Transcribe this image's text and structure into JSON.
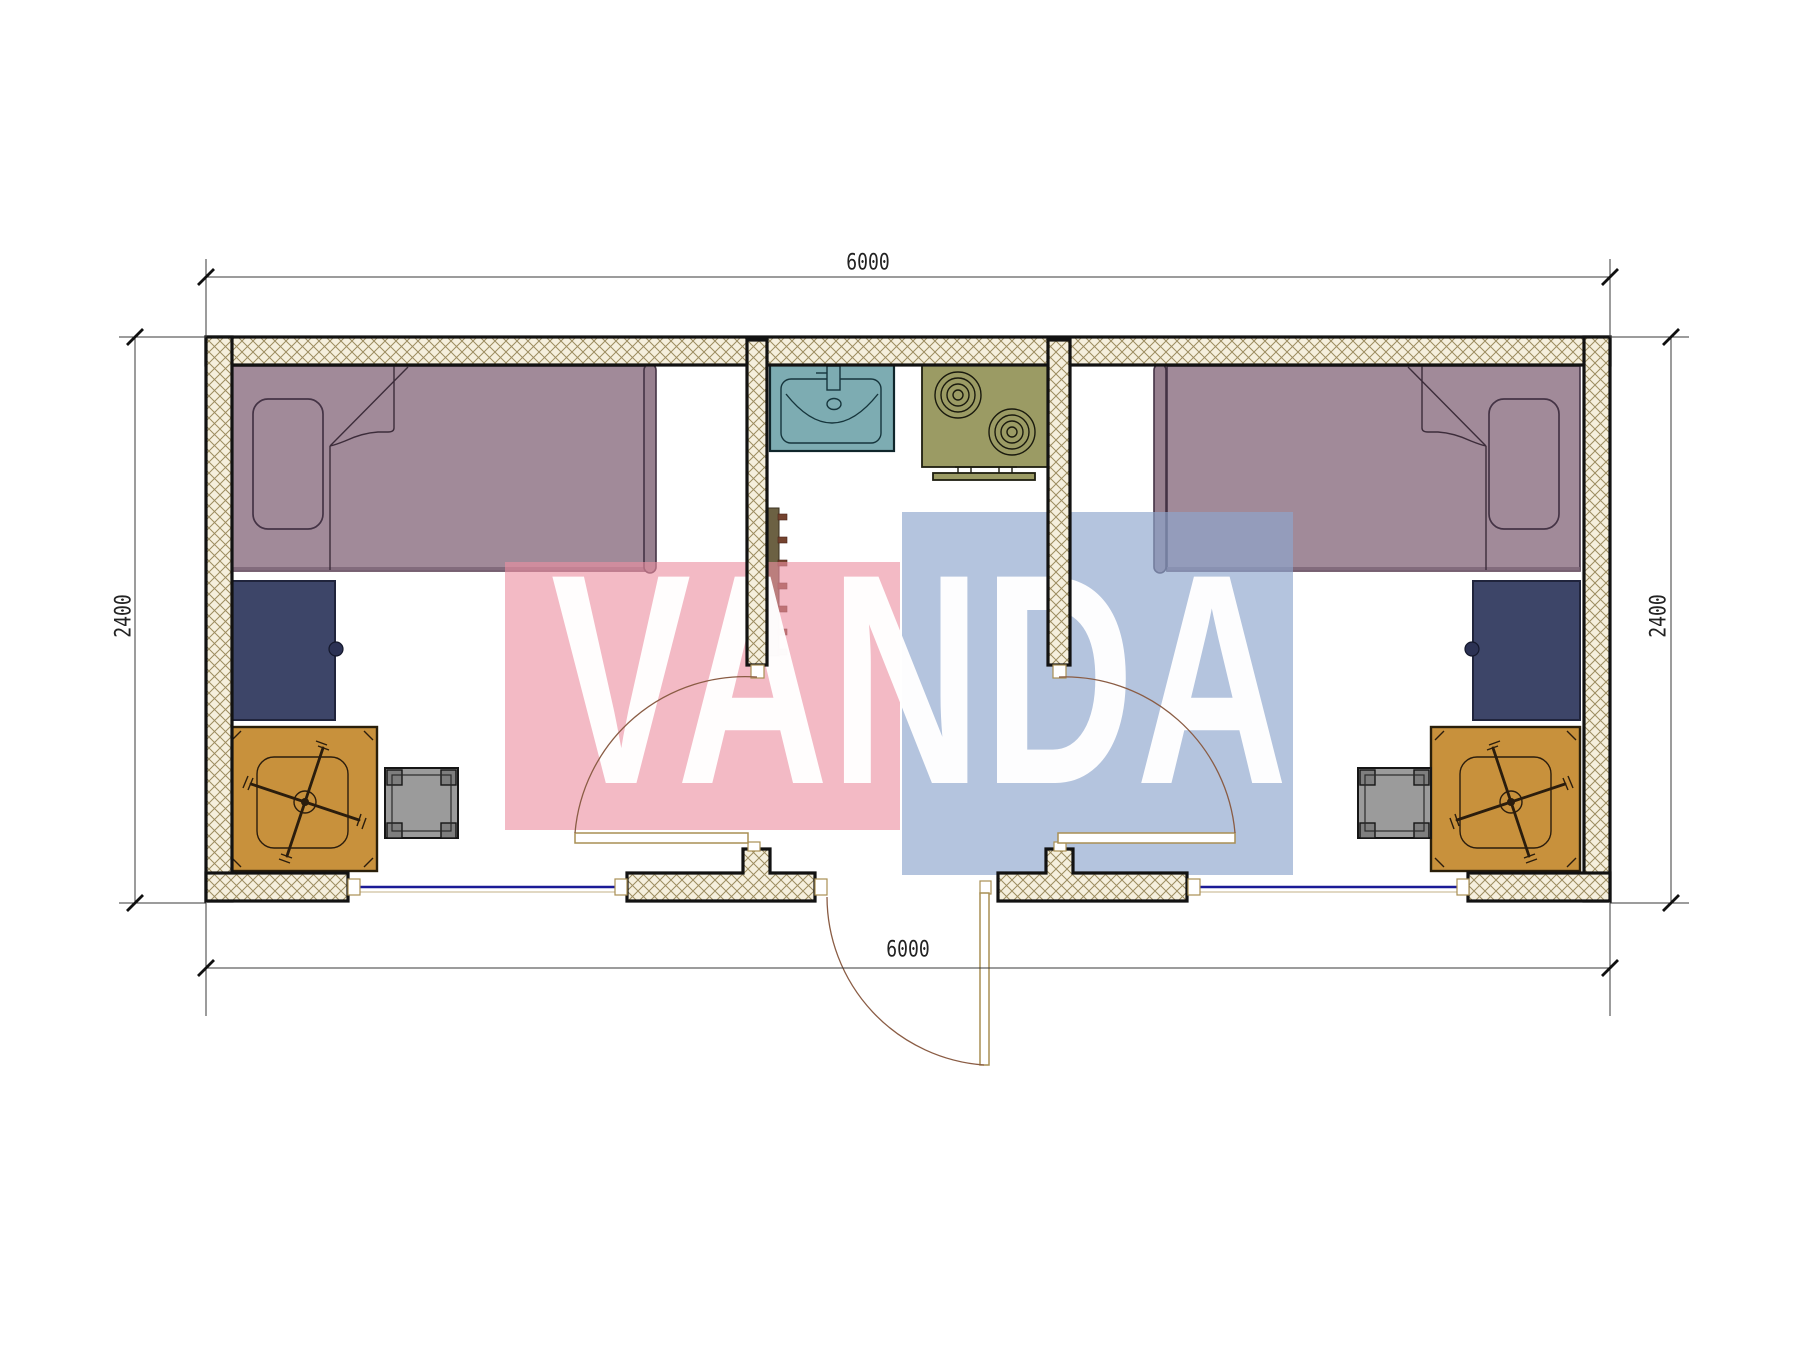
{
  "drawing": {
    "type": "floor-plan",
    "watermark": {
      "text": "VANDA"
    },
    "dimensions": {
      "top": "6000",
      "bottom": "6000",
      "left": "2400",
      "right": "2400"
    },
    "colors": {
      "wall_fill": "#f5efdd",
      "wall_hatch": "#9c8c60",
      "wall_border": "#121212",
      "bed": "#a18a99",
      "bed_outline": "#443345",
      "bed_bar": "#97808f",
      "bed_shadow": "#7c6577",
      "wardrobe": "#3d4568",
      "wardrobe_border": "#20243c",
      "desk": "#c8913c",
      "desk_border": "#2a1f0a",
      "chair": "#2b1d0d",
      "stool": "#9b9b9b",
      "stool_dark": "#7e7e7e",
      "sink": "#7dacb2",
      "stove": "#9b9b64",
      "radiator": "#6c6143",
      "radiator_fins": "#74432f",
      "window": "#1b1b96",
      "door_leaf": "#a98f54",
      "door_arc": "#8a5c44",
      "dim_line": "#3a3a3a",
      "dim_text": "#222222",
      "wm_pink": "rgba(236,144,162,0.62)",
      "wm_blue": "rgba(141,166,205,0.66)",
      "wm_text": "rgba(255,255,255,0.97)"
    }
  }
}
